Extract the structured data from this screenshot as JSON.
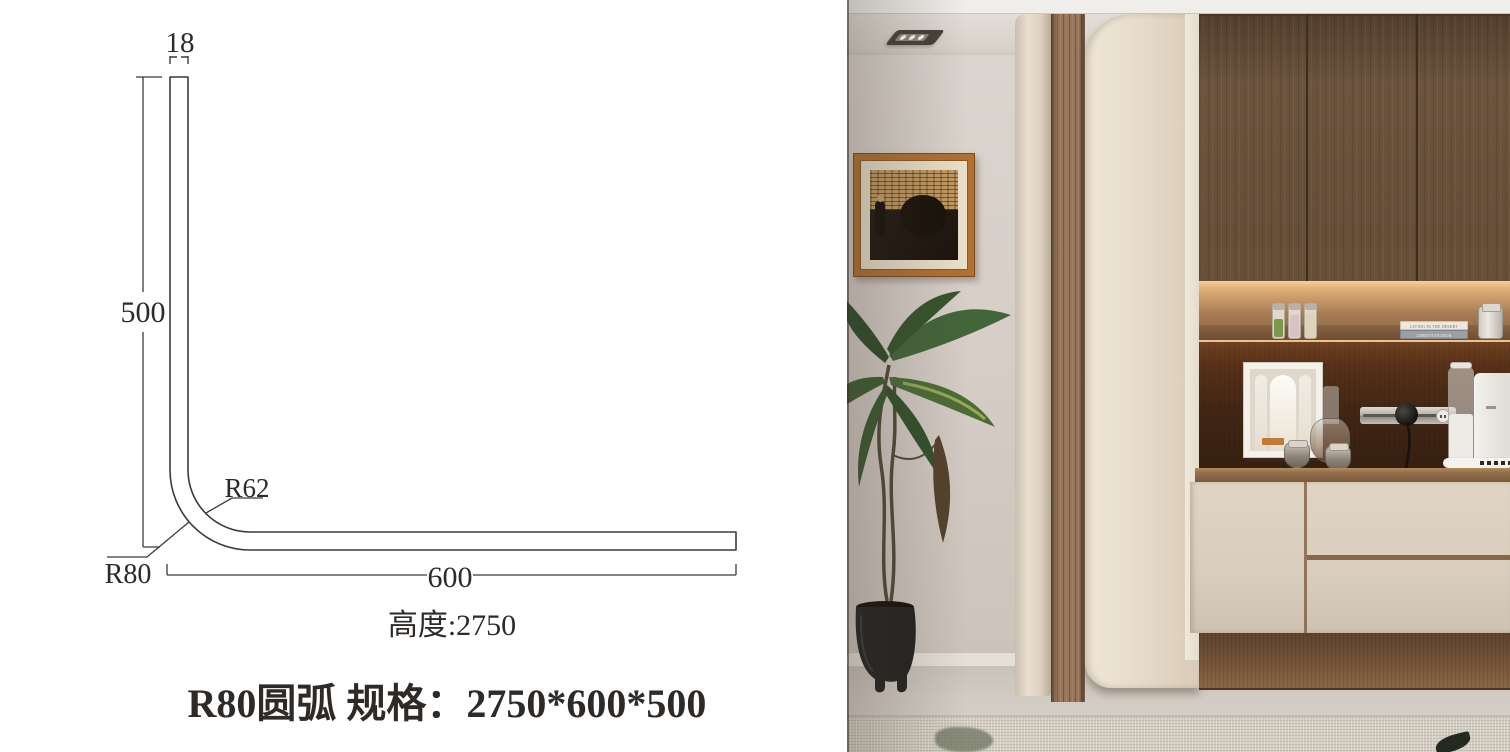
{
  "diagram": {
    "dim_top": "18",
    "dim_left": "500",
    "dim_bottom": "600",
    "radius_inner": "R62",
    "radius_outer": "R80",
    "height_note": "高度:2750",
    "title": "R80圆弧  规格：2750*600*500",
    "line_color": "#3f3b37"
  },
  "photo": {
    "shelf_books": {
      "top_spine": "LIVING IN THE DESERT",
      "bottom_spine": "CHRISTIAN DIOR"
    },
    "colors": {
      "frame_orange": "#b1712f",
      "cabinet_wood": "#6b533d",
      "panel_cream": "#e7dccb",
      "led_glow": "#f0c48d",
      "wall_grey": "#d5cdc6"
    }
  }
}
